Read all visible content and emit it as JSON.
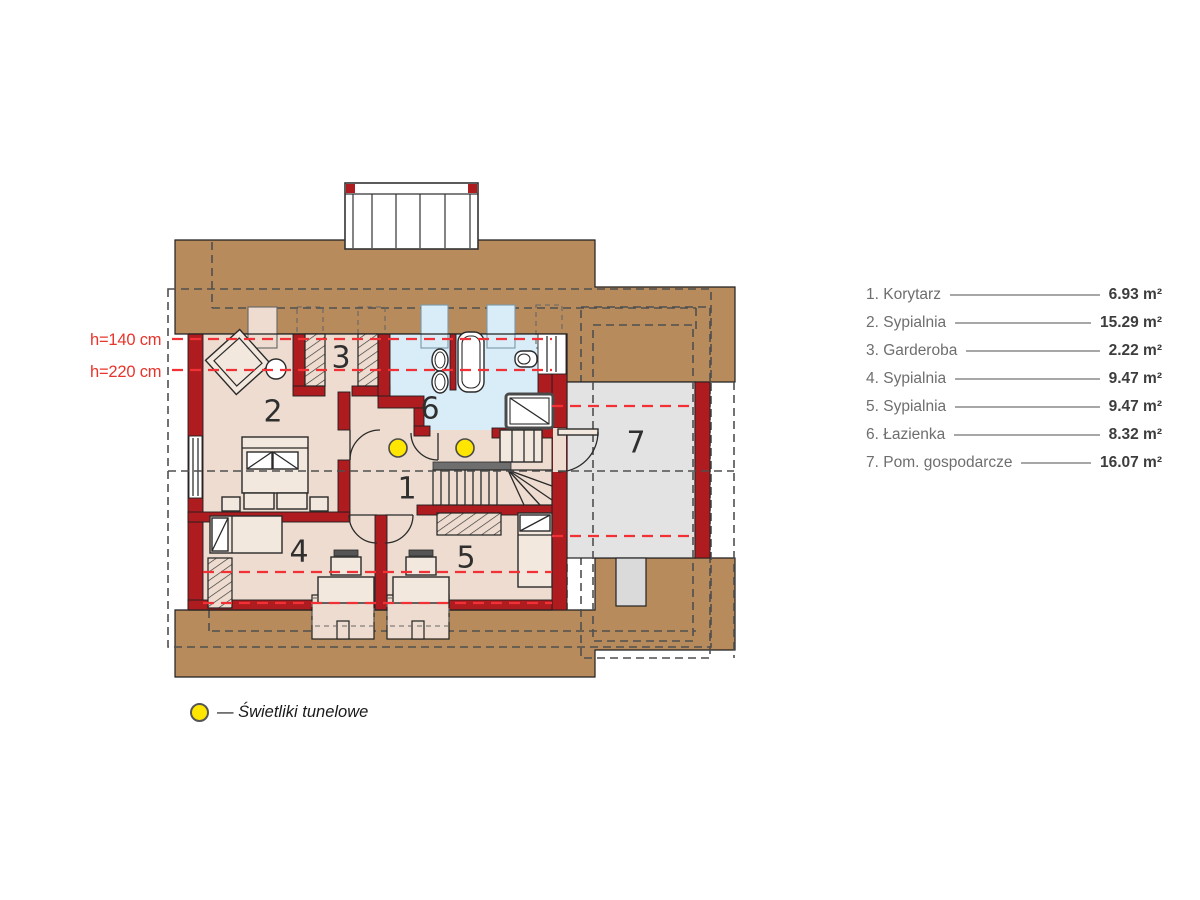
{
  "colors": {
    "roof-brown": "#b78b5c",
    "wall-red": "#ae1c20",
    "floor-beige": "#eddccf",
    "floor-beige-light": "#f2e8de",
    "bath-blue": "#d9edf8",
    "room7-gray": "#e3e3e3",
    "dash-red": "#f23137",
    "dash-dark": "#4f4f4f",
    "skylight-yellow": "#ffe600",
    "legend-name": "#6e6e6e",
    "legend-value": "#3d3d3d",
    "height-label-red": "#e8352c"
  },
  "plan": {
    "room_numbers": [
      "1",
      "2",
      "3",
      "4",
      "5",
      "6",
      "7"
    ],
    "height_labels": {
      "upper": "h=140 cm",
      "lower": "h=220 cm"
    }
  },
  "legend": {
    "rows": [
      {
        "label": "1. Korytarz",
        "area": "6.93 m²"
      },
      {
        "label": "2. Sypialnia",
        "area": "15.29 m²"
      },
      {
        "label": "3. Garderoba",
        "area": "2.22 m²"
      },
      {
        "label": "4. Sypialnia",
        "area": "9.47 m²"
      },
      {
        "label": "5. Sypialnia",
        "area": "9.47 m²"
      },
      {
        "label": "6. Łazienka",
        "area": "8.32 m²"
      },
      {
        "label": "7. Pom. gospodarcze",
        "area": "16.07 m²"
      }
    ]
  },
  "footnote": {
    "text": "— Świetliki tunelowe"
  }
}
